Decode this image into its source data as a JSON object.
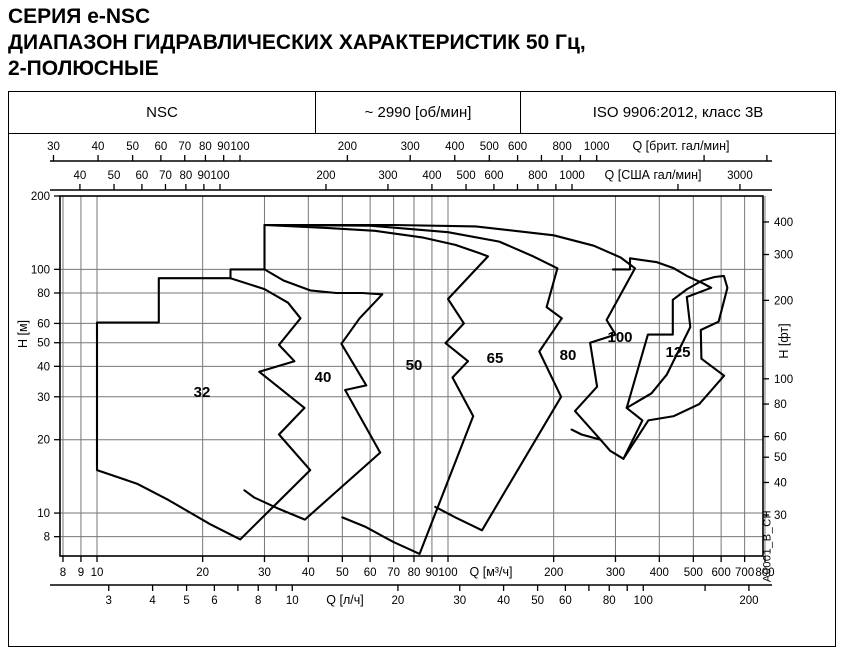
{
  "title": {
    "line1": "СЕРИЯ e-NSC",
    "line2": "ДИАПАЗОН ГИДРАВЛИЧЕСКИХ ХАРАКТЕРИСТИК 50 Гц,",
    "line3": "2-ПОЛЮСНЫЕ"
  },
  "header": {
    "series": "NSC",
    "speed": "~ 2990 [об/мин]",
    "standard": "ISO 9906:2012, класс 3В"
  },
  "footnote": "A0001_B_CH",
  "chart_data": {
    "type": "area",
    "title": "Диапазон гидравлических характеристик NSC, 50 Гц, 2-полюсные",
    "x_axis_main": {
      "unit": "Q [м³/ч]",
      "scale": "log",
      "ticks": [
        8,
        9,
        10,
        20,
        30,
        40,
        50,
        60,
        70,
        80,
        90,
        100,
        200,
        300,
        400,
        500,
        600,
        700,
        800
      ]
    },
    "x_axis_ls": {
      "unit": "Q [л/ч]",
      "scale": "log",
      "ticks": [
        3,
        4,
        5,
        6,
        8,
        10,
        20,
        30,
        40,
        50,
        60,
        80,
        100,
        200
      ],
      "minor_ticks": [
        7,
        9,
        70,
        90,
        150
      ]
    },
    "x_axis_brit": {
      "unit": "Q [брит. гал/мин]",
      "scale": "log",
      "ticks": [
        30,
        40,
        50,
        60,
        70,
        80,
        90,
        100,
        200,
        300,
        400,
        500,
        600,
        800,
        1000
      ],
      "minor_ticks": [
        700,
        900,
        2000,
        3000
      ]
    },
    "x_axis_usa": {
      "unit": "Q [США гал/мин]",
      "scale": "log",
      "ticks": [
        40,
        50,
        60,
        70,
        80,
        90,
        100,
        200,
        300,
        400,
        500,
        600,
        800,
        1000,
        3000
      ],
      "minor_ticks": [
        700,
        900,
        2000
      ]
    },
    "y_axis_m": {
      "unit": "H [м]",
      "scale": "log",
      "range": [
        6.7,
        200
      ],
      "ticks": [
        200,
        100,
        80,
        60,
        50,
        40,
        30,
        20,
        10,
        8
      ]
    },
    "y_axis_ft": {
      "unit": "H [фт]",
      "scale": "log",
      "ticks": [
        400,
        300,
        200,
        100,
        80,
        60,
        50,
        40,
        30
      ]
    },
    "grid": {
      "q_lines": [
        8,
        9,
        10,
        20,
        30,
        40,
        50,
        60,
        70,
        80,
        90,
        100,
        200,
        300,
        400,
        500,
        600,
        700,
        800
      ],
      "h_lines": [
        8,
        10,
        20,
        30,
        40,
        50,
        60,
        80,
        100
      ]
    },
    "regions": [
      {
        "label": "32",
        "label_xy": [
          202,
          397
        ],
        "closed": true,
        "outline": [
          [
            10,
            15
          ],
          [
            10,
            60.5
          ],
          [
            15,
            60.5
          ],
          [
            15,
            92
          ],
          [
            24,
            92
          ],
          [
            30,
            83
          ],
          [
            35,
            73
          ],
          [
            38,
            63
          ],
          [
            33,
            49
          ],
          [
            36.5,
            42
          ],
          [
            29,
            38
          ],
          [
            39,
            27
          ],
          [
            33,
            21
          ],
          [
            40.5,
            15
          ],
          [
            25.6,
            7.8
          ],
          [
            21,
            9
          ],
          [
            16,
            11.3
          ],
          [
            13,
            13.2
          ],
          [
            10,
            15
          ]
        ]
      },
      {
        "label": "40",
        "label_xy": [
          323,
          382
        ],
        "closed": false,
        "outline": [
          [
            24,
            92
          ],
          [
            24,
            100
          ],
          [
            30,
            100
          ],
          [
            34,
            90
          ],
          [
            40.5,
            82
          ],
          [
            48,
            80
          ],
          [
            57,
            80
          ],
          [
            65,
            79
          ],
          [
            56,
            63
          ],
          [
            49.7,
            49.5
          ],
          [
            58.5,
            33.4
          ],
          [
            50.9,
            32
          ],
          [
            64.1,
            17.7
          ],
          [
            39.1,
            9.4
          ],
          [
            33,
            10.4
          ],
          [
            28,
            11.6
          ],
          [
            26.3,
            12.4
          ]
        ]
      },
      {
        "label": "50",
        "label_xy": [
          414,
          370
        ],
        "closed": false,
        "outline": [
          [
            30,
            100
          ],
          [
            30,
            152
          ],
          [
            45,
            148
          ],
          [
            62,
            144
          ],
          [
            85,
            135
          ],
          [
            105,
            126
          ],
          [
            122,
            117
          ],
          [
            130,
            113
          ],
          [
            100,
            75.6
          ],
          [
            111,
            60
          ],
          [
            98.4,
            49.8
          ],
          [
            114,
            42
          ],
          [
            103,
            36
          ],
          [
            118,
            25
          ],
          [
            83,
            6.8
          ],
          [
            70,
            7.6
          ],
          [
            58,
            8.8
          ],
          [
            50,
            9.6
          ]
        ]
      },
      {
        "label": "65",
        "label_xy": [
          495,
          363
        ],
        "closed": false,
        "outline": [
          [
            30,
            152
          ],
          [
            60,
            151
          ],
          [
            100,
            142
          ],
          [
            140,
            130
          ],
          [
            175,
            113
          ],
          [
            205,
            101
          ],
          [
            191,
            70
          ],
          [
            211,
            63
          ],
          [
            182,
            46
          ],
          [
            210,
            30
          ],
          [
            125,
            8.5
          ],
          [
            105,
            9.6
          ],
          [
            92,
            10.6
          ]
        ]
      },
      {
        "label": "80",
        "label_xy": [
          568,
          360
        ],
        "closed": false,
        "outline": [
          [
            30,
            152
          ],
          [
            70,
            152
          ],
          [
            120,
            150
          ],
          [
            200,
            138
          ],
          [
            260,
            125
          ],
          [
            310,
            112
          ],
          [
            341,
            101
          ],
          [
            283,
            62
          ],
          [
            300,
            54
          ],
          [
            254,
            50
          ],
          [
            266,
            33
          ],
          [
            230,
            26.2
          ],
          [
            272,
            20
          ],
          [
            240,
            21
          ],
          [
            225,
            22
          ]
        ]
      },
      {
        "label": "100",
        "label_xy": [
          620,
          342
        ],
        "closed": false,
        "outline": [
          [
            295,
            100
          ],
          [
            330,
            100
          ],
          [
            330,
            111
          ],
          [
            394,
            107
          ],
          [
            440,
            101
          ],
          [
            479,
            94
          ],
          [
            530,
            88
          ],
          [
            562,
            84
          ],
          [
            479,
            77
          ],
          [
            490,
            58
          ],
          [
            420,
            37
          ],
          [
            380,
            31
          ],
          [
            323,
            27
          ],
          [
            358,
            24
          ],
          [
            316,
            16.7
          ],
          [
            290,
            18
          ],
          [
            272,
            20
          ]
        ]
      },
      {
        "label": "125",
        "label_xy": [
          678,
          357
        ],
        "closed": false,
        "outline": [
          [
            323,
            27
          ],
          [
            371,
            54
          ],
          [
            437,
            54
          ],
          [
            437,
            75
          ],
          [
            480,
            83
          ],
          [
            530,
            90
          ],
          [
            575,
            93
          ],
          [
            611,
            94
          ],
          [
            625,
            84
          ],
          [
            590,
            61
          ],
          [
            525,
            56.4
          ],
          [
            527,
            43
          ],
          [
            612,
            36.6
          ],
          [
            520,
            28
          ],
          [
            440,
            25
          ],
          [
            372,
            24
          ],
          [
            316,
            16.7
          ]
        ]
      }
    ]
  }
}
